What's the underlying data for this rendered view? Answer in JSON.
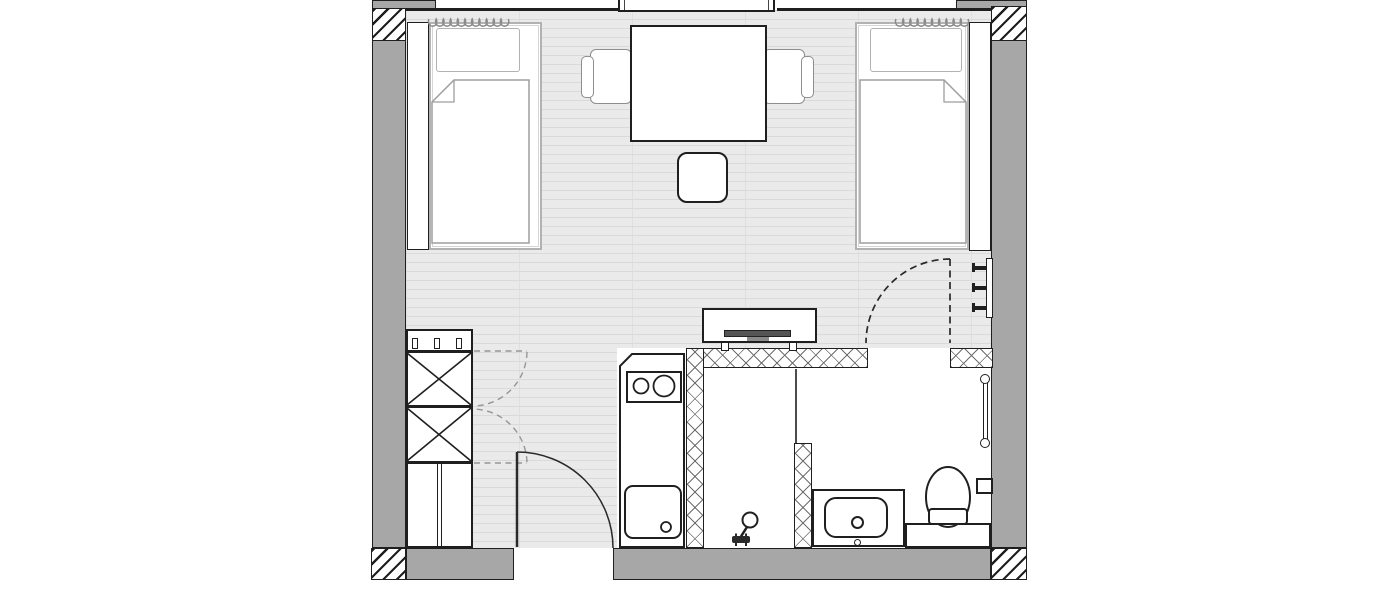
{
  "plan": {
    "type": "studio-room-floor-plan",
    "colors": {
      "wall_fill": "#a7a7a7",
      "outline": "#1f1f1f",
      "furniture_light_line": "#b2b2b2",
      "floor_fill": "#eaeaea",
      "floor_line": "#dadada",
      "wet_area_floor": "#ffffff",
      "tv_screen": "#555555",
      "dashed_swing": "#999999"
    },
    "bedroom": {
      "furniture": [
        "single-bed-left",
        "single-bed-right",
        "pillow-left",
        "pillow-right",
        "duvet-left",
        "duvet-right",
        "bedside-panel-left",
        "bedside-panel-right",
        "table",
        "armchair-left",
        "armchair-right",
        "stool",
        "tv-console",
        "tv",
        "wardrobe-with-cross-boxes",
        "hanger-rail",
        "coat-hooks",
        "radiator-left",
        "radiator-right"
      ]
    },
    "kitchenette": {
      "fixtures": [
        "counter-chamfered",
        "two-burner-cooktop",
        "kitchen-sink-with-drain"
      ]
    },
    "bathroom": {
      "fixtures": [
        "walk-in-shower",
        "hand-shower",
        "glass-screen",
        "vanity-counter",
        "washbasin",
        "basin-faucet",
        "toilet",
        "toilet-plinth",
        "flush-plate",
        "towel-rail"
      ]
    },
    "openings": {
      "entry_door": "bottom-wall-hinged-left-swing-in",
      "bathroom_door": "dashed-swing-into-bedroom",
      "wardrobe_doors": "two-dashed-swings",
      "window_bay": "top-wall-center"
    },
    "walls": [
      "left-wall",
      "right-wall",
      "bottom-wall",
      "top-wall-line",
      "corner-hatch-top-left",
      "corner-hatch-top-right",
      "corner-hatch-bottom-left",
      "corner-hatch-bottom-right",
      "tiled-partition-walls-x-lattice"
    ]
  }
}
